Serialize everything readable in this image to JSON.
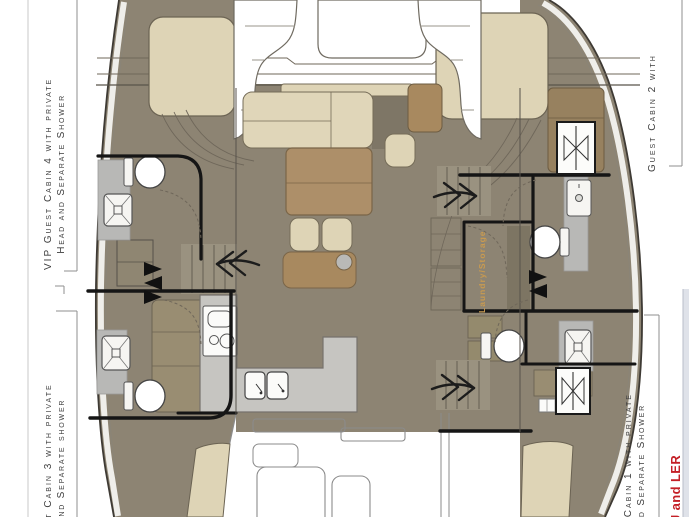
{
  "plan": {
    "name": "Catamaran interior deck plan",
    "labels": {
      "cabin4_line1": "VIP Guest Cabin 4 with private",
      "cabin4_line2": "Head and Separate Shower",
      "cabin3_line1": "est Cabin 3 with private",
      "cabin3_line2": "nd Separate shower",
      "cabin2_line1": "Guest Cabin 2 with",
      "cabin1_line1": "st Cabin 1 with private",
      "cabin1_line2": "nd Separate Shower",
      "laundry_room": "Laundry/Storage",
      "red_note": "J and LER"
    },
    "colors": {
      "floor_taupe": "#8d8473",
      "furniture_beige": "#ded4b6",
      "furniture_brown": "#a8895f",
      "table_brown": "#ad8f69",
      "counter_gray": "#c6c5c1",
      "shower_gray": "#b8b8b6",
      "bulkhead_black": "#151515",
      "laundry_text_orange": "#c89a50",
      "note_red": "#c41f26",
      "label_gray": "#3d3d3d"
    },
    "icons": [
      "toilet-icon",
      "shower-drain-icon",
      "washbasin-icon",
      "escape-hatch-icon",
      "accordion-door-icon",
      "stairs-arrow-icon",
      "cooktop-icon",
      "double-sink-icon"
    ]
  }
}
